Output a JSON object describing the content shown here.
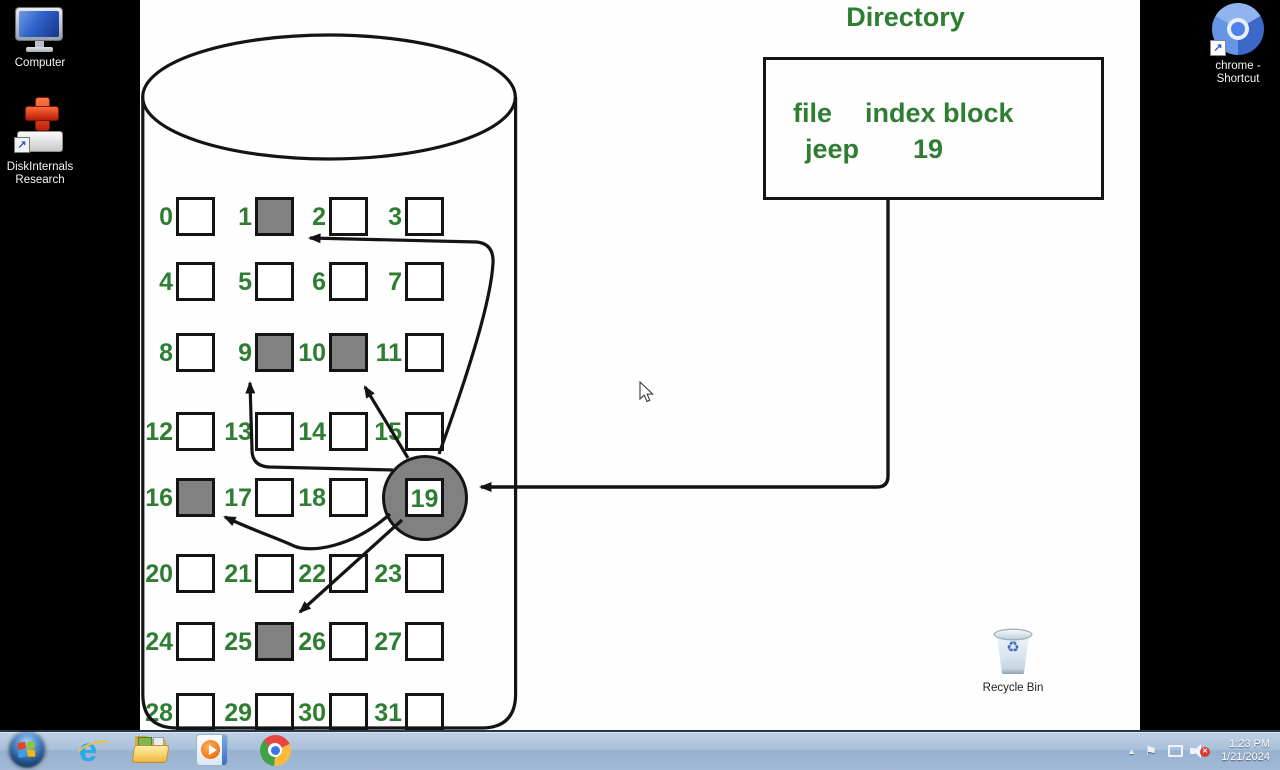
{
  "desktop": {
    "icons": [
      {
        "id": "computer",
        "label": "Computer",
        "icon": "computer-icon"
      },
      {
        "id": "diskinternals-research",
        "label": "DiskInternals Research",
        "icon": "diskinternals-icon"
      },
      {
        "id": "chrome-shortcut",
        "label": "chrome - Shortcut",
        "icon": "chromium-icon"
      },
      {
        "id": "recycle-bin",
        "label": "Recycle Bin",
        "icon": "recycle-bin-icon"
      }
    ]
  },
  "diagram": {
    "title": "Directory",
    "directory": {
      "columns": [
        "file",
        "index block"
      ],
      "entry": {
        "file": "jeep",
        "index_block": "19"
      }
    },
    "disk": {
      "index_block": 19,
      "pointed_blocks": [
        1,
        9,
        10,
        16,
        25
      ],
      "blocks": [
        {
          "n": 0,
          "state": "free"
        },
        {
          "n": 1,
          "state": "used"
        },
        {
          "n": 2,
          "state": "free"
        },
        {
          "n": 3,
          "state": "free"
        },
        {
          "n": 4,
          "state": "free"
        },
        {
          "n": 5,
          "state": "free"
        },
        {
          "n": 6,
          "state": "free"
        },
        {
          "n": 7,
          "state": "free"
        },
        {
          "n": 8,
          "state": "free"
        },
        {
          "n": 9,
          "state": "used"
        },
        {
          "n": 10,
          "state": "used"
        },
        {
          "n": 11,
          "state": "free"
        },
        {
          "n": 12,
          "state": "free"
        },
        {
          "n": 13,
          "state": "free"
        },
        {
          "n": 14,
          "state": "free"
        },
        {
          "n": 15,
          "state": "free"
        },
        {
          "n": 16,
          "state": "used"
        },
        {
          "n": 17,
          "state": "free"
        },
        {
          "n": 18,
          "state": "free"
        },
        {
          "n": 19,
          "state": "index"
        },
        {
          "n": 20,
          "state": "free"
        },
        {
          "n": 21,
          "state": "free"
        },
        {
          "n": 22,
          "state": "free"
        },
        {
          "n": 23,
          "state": "free"
        },
        {
          "n": 24,
          "state": "free"
        },
        {
          "n": 25,
          "state": "used"
        },
        {
          "n": 26,
          "state": "free"
        },
        {
          "n": 27,
          "state": "free"
        },
        {
          "n": 28,
          "state": "free"
        },
        {
          "n": 29,
          "state": "free"
        },
        {
          "n": 30,
          "state": "free"
        },
        {
          "n": 31,
          "state": "free"
        }
      ]
    },
    "colors": {
      "green": "#2e7d32",
      "block_gray": "#818181",
      "line": "#141414"
    }
  },
  "taskbar": {
    "apps": [
      {
        "id": "start",
        "icon": "windows-start-icon"
      },
      {
        "id": "internet-explorer",
        "icon": "internet-explorer-icon"
      },
      {
        "id": "windows-explorer",
        "icon": "folder-icon"
      },
      {
        "id": "windows-media-player",
        "icon": "media-player-icon"
      },
      {
        "id": "chrome",
        "icon": "chrome-icon"
      }
    ],
    "tray": {
      "hidden_icons_glyph": "▲",
      "flag_glyph": "⚑",
      "mute_glyph": "✕",
      "clock": {
        "time": "1:23 PM",
        "date": "1/21/2024"
      }
    }
  }
}
